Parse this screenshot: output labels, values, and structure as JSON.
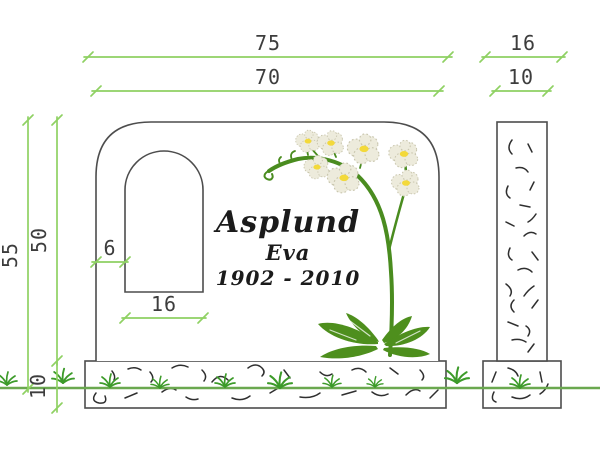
{
  "colors": {
    "background": "#ffffff",
    "dimension_line": "#8fd163",
    "dim_text": "#3d3d3d",
    "outline": "#4d4d4d",
    "texture": "#2f2f2f",
    "ground": "#6aa84f",
    "grass": "#3d9b2a",
    "stem": "#4a8c1f",
    "leaf": "#4e8f1d",
    "petal": "#edebdc",
    "petal_edge": "#c9c6ae",
    "flower_center": "#f3d93a",
    "inscription": "#1b1b1b"
  },
  "dimensions": {
    "front": {
      "total_width": "75",
      "stone_width": "70",
      "total_height": "55",
      "stone_height": "50",
      "base_height": "10",
      "niche_offset": "6",
      "niche_width": "16"
    },
    "side": {
      "base_depth": "16",
      "stone_depth": "10"
    }
  },
  "inscription": {
    "surname": "Asplund",
    "given_name": "Eva",
    "years": "1902 - 2010"
  }
}
